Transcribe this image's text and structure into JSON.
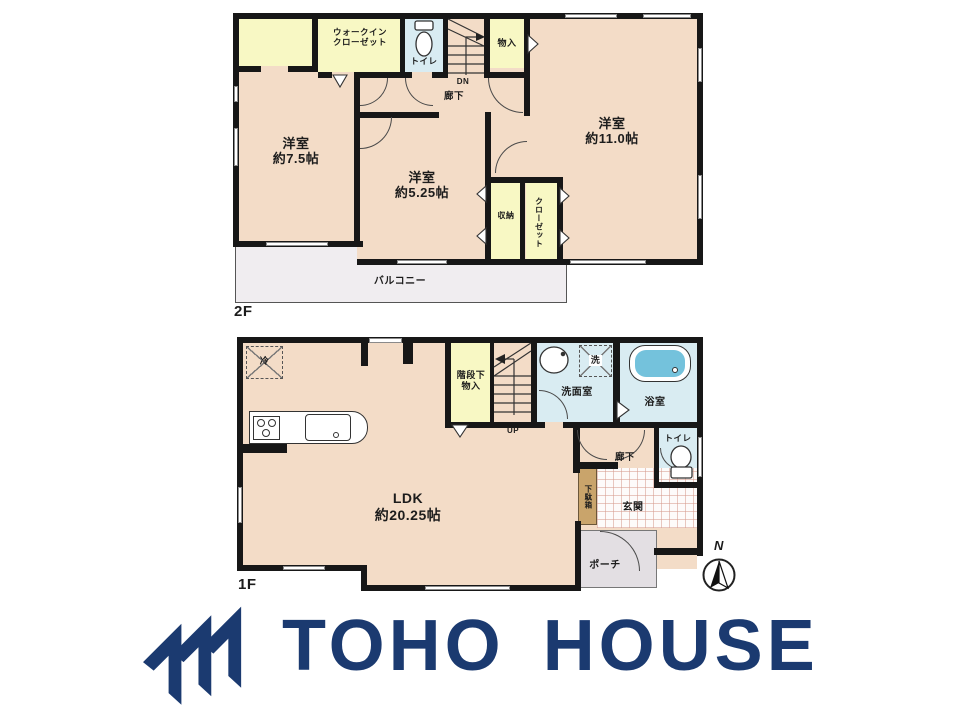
{
  "floor2": {
    "label": "2F",
    "bedroom_a": {
      "name": "洋室",
      "size": "約7.5帖"
    },
    "bedroom_b": {
      "name": "洋室",
      "size": "約5.25帖"
    },
    "bedroom_c": {
      "name": "洋室",
      "size": "約11.0帖"
    },
    "walk_in_closet": {
      "line1": "ウォークイン",
      "line2": "クローゼット"
    },
    "toilet": "トイレ",
    "storage": "物入",
    "hallway": "廊下",
    "stair_direction": "DN",
    "closet_small": "収納",
    "closet": "クローゼット",
    "balcony": "バルコニー"
  },
  "floor1": {
    "label": "1F",
    "ldk": {
      "name": "LDK",
      "size": "約20.25帖"
    },
    "under_stair_storage": {
      "line1": "階段下",
      "line2": "物入"
    },
    "stair_direction": "UP",
    "washroom": "洗面室",
    "washer": "洗",
    "bathroom": "浴室",
    "refrigerator": "冷",
    "hallway": "廊下",
    "toilet": "トイレ",
    "shoe_cabinet": "下駄箱",
    "entrance": "玄関",
    "porch": "ポーチ",
    "compass_north": "N"
  },
  "logo": {
    "text": "TOHO HOUSE",
    "color": "#1b3a70"
  },
  "colors": {
    "wall": "#171717",
    "room_floor": "#f3dcc7",
    "closet_floor": "#f8f8c4",
    "wet_floor": "#d9ecf2",
    "bathtub": "#74c2dc",
    "balcony": "#f0edf0",
    "porch": "#e3dfe3",
    "shoe_cabinet": "#c9a46b",
    "logo_navy": "#1b3a70"
  }
}
